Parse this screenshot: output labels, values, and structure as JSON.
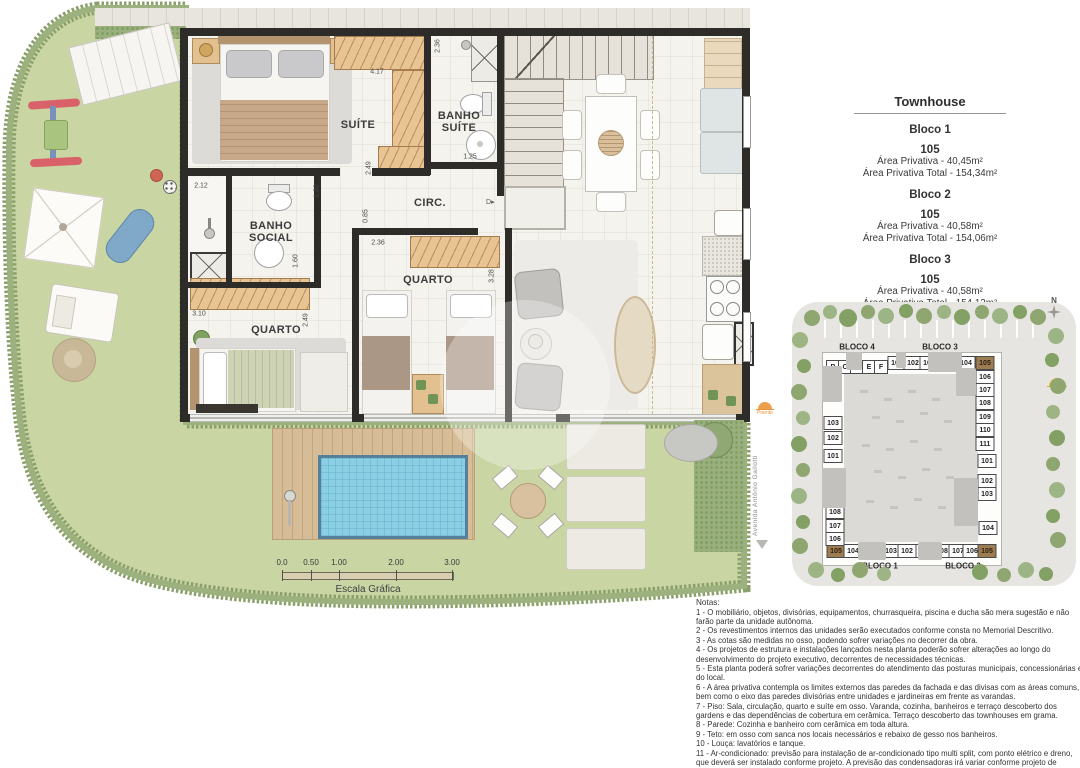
{
  "info_panel": {
    "title": "Townhouse",
    "blocks": [
      {
        "name": "Bloco 1",
        "unit": "105",
        "area1": "Área Privativa - 40,45m²",
        "area2": "Área Privativa Total - 154,34m²"
      },
      {
        "name": "Bloco 2",
        "unit": "105",
        "area1": "Área Privativa - 40,58m²",
        "area2": "Área Privativa Total - 154,06m²"
      },
      {
        "name": "Bloco 3",
        "unit": "105",
        "area1": "Área Privativa - 40,58m²",
        "area2": "Área Privativa Total - 154,12m²"
      }
    ]
  },
  "plan": {
    "room_labels": [
      {
        "t": "SUÍTE",
        "x": 358,
        "y": 125
      },
      {
        "t": "BANHO\nSUÍTE",
        "x": 459,
        "y": 122
      },
      {
        "t": "CIRC.",
        "x": 430,
        "y": 203
      },
      {
        "t": "BANHO\nSOCIAL",
        "x": 271,
        "y": 232
      },
      {
        "t": "QUARTO",
        "x": 276,
        "y": 330
      },
      {
        "t": "QUARTO",
        "x": 428,
        "y": 280
      }
    ],
    "dimensions": [
      {
        "t": "2.36",
        "x": 438,
        "y": 46,
        "r": 1
      },
      {
        "t": "4.17",
        "x": 377,
        "y": 72
      },
      {
        "t": "2.49",
        "x": 369,
        "y": 168,
        "r": 1
      },
      {
        "t": "1.25",
        "x": 470,
        "y": 157
      },
      {
        "t": "2.12",
        "x": 201,
        "y": 186
      },
      {
        "t": "1.32",
        "x": 317,
        "y": 191,
        "r": 1
      },
      {
        "t": "0.85",
        "x": 366,
        "y": 216,
        "r": 1
      },
      {
        "t": "2.36",
        "x": 378,
        "y": 243
      },
      {
        "t": "1.60",
        "x": 296,
        "y": 261,
        "r": 1
      },
      {
        "t": "3.10",
        "x": 199,
        "y": 314
      },
      {
        "t": "2.49",
        "x": 306,
        "y": 320,
        "r": 1
      },
      {
        "t": "3.28",
        "x": 492,
        "y": 276,
        "r": 1
      }
    ],
    "door_symbol": "D",
    "poente_label": "Poente"
  },
  "scalebar": {
    "ticks": [
      {
        "label": "0.0",
        "x": 0
      },
      {
        "label": "0.50",
        "x": 29
      },
      {
        "label": "1.00",
        "x": 57
      },
      {
        "label": "2.00",
        "x": 114
      },
      {
        "label": "3.00",
        "x": 170
      }
    ],
    "caption": "Escala Gráfica"
  },
  "keyplan": {
    "north_label": "N",
    "street": "Avenida Antônio Gallotti",
    "bloco_labels": [
      {
        "t": "BLOCO 4",
        "x": 857,
        "y": 347
      },
      {
        "t": "BLOCO 3",
        "x": 940,
        "y": 347
      },
      {
        "t": "BLOCO 1",
        "x": 880,
        "y": 566
      },
      {
        "t": "BLOCO 2",
        "x": 963,
        "y": 566
      }
    ],
    "cells": [
      {
        "t": "B",
        "x": 833,
        "y": 367
      },
      {
        "t": "C",
        "x": 845,
        "y": 367
      },
      {
        "t": "D",
        "x": 857,
        "y": 367
      },
      {
        "t": "E",
        "x": 869,
        "y": 367
      },
      {
        "t": "F",
        "x": 881,
        "y": 367
      },
      {
        "t": "A",
        "x": 833,
        "y": 384
      },
      {
        "t": "101",
        "x": 897,
        "y": 363
      },
      {
        "t": "102",
        "x": 913,
        "y": 363
      },
      {
        "t": "103",
        "x": 929,
        "y": 363
      },
      {
        "t": "104",
        "x": 966,
        "y": 363
      },
      {
        "t": "105",
        "x": 985,
        "y": 363,
        "h": true
      },
      {
        "t": "106",
        "x": 985,
        "y": 377
      },
      {
        "t": "107",
        "x": 985,
        "y": 390
      },
      {
        "t": "108",
        "x": 985,
        "y": 403
      },
      {
        "t": "109",
        "x": 985,
        "y": 417
      },
      {
        "t": "110",
        "x": 985,
        "y": 430
      },
      {
        "t": "111",
        "x": 985,
        "y": 444
      },
      {
        "t": "101",
        "x": 987,
        "y": 461
      },
      {
        "t": "102",
        "x": 987,
        "y": 481
      },
      {
        "t": "103",
        "x": 987,
        "y": 494
      },
      {
        "t": "104",
        "x": 988,
        "y": 528
      },
      {
        "t": "105",
        "x": 836,
        "y": 551,
        "h": true
      },
      {
        "t": "104",
        "x": 853,
        "y": 551
      },
      {
        "t": "103",
        "x": 891,
        "y": 551
      },
      {
        "t": "102",
        "x": 907,
        "y": 551
      },
      {
        "t": "101",
        "x": 925,
        "y": 551
      },
      {
        "t": "108",
        "x": 942,
        "y": 551
      },
      {
        "t": "107",
        "x": 958,
        "y": 551
      },
      {
        "t": "106",
        "x": 972,
        "y": 551
      },
      {
        "t": "105",
        "x": 987,
        "y": 551,
        "h": true
      },
      {
        "t": "103",
        "x": 833,
        "y": 423
      },
      {
        "t": "102",
        "x": 833,
        "y": 438
      },
      {
        "t": "101",
        "x": 833,
        "y": 456
      },
      {
        "t": "108",
        "x": 835,
        "y": 512
      },
      {
        "t": "107",
        "x": 835,
        "y": 526
      },
      {
        "t": "106",
        "x": 835,
        "y": 539
      }
    ]
  },
  "notes": {
    "heading": "Notas:",
    "items": [
      "1 - O mobiliário, objetos, divisórias, equipamentos, churrasqueira, piscina e ducha são mera sugestão e não farão parte da unidade autônoma.",
      "2 - Os revestimentos internos das unidades serão executados conforme consta no Memorial Descritivo.",
      "3 - As cotas são medidas no osso, podendo sofrer variações no decorrer da obra.",
      "4 - Os projetos de estrutura e instalações lançados nesta planta poderão sofrer alterações ao longo do desenvolvimento do projeto executivo, decorrentes de necessidades técnicas.",
      "5 - Esta planta poderá sofrer variações decorrentes do atendimento das posturas municipais, concessionárias e do local.",
      "6 - A área privativa contempla os limites externos das paredes da fachada e das divisas com as áreas comuns, bem como o eixo das paredes divisórias entre unidades e jardineiras em frente as varandas.",
      "7 - Piso: Sala, circulação, quarto e suíte em osso. Varanda, cozinha, banheiros e terraço descoberto dos gardens e das dependências de cobertura em cerâmica. Terraço descoberto das townhouses em grama.",
      "8 - Parede: Cozinha e banheiro com cerâmica em toda altura.",
      "9 - Teto: em osso com sanca nos locais necessários e rebaixo de gesso nos banheiros.",
      "10 - Louça: lavatórios e tanque.",
      "11 - Ar-condicionado: previsão para instalação de ar-condicionado tipo multi split, com ponto elétrico e dreno, que deverá ser instalado conforme projeto. A previsão das condensadoras irá variar conforme projeto de fachada."
    ]
  },
  "colors": {
    "grass": "#c9d6a4",
    "hedge": "#8ba06c",
    "wall": "#2e2c29",
    "pool": "#8bcfe5",
    "deck": "#d7bd97",
    "closet_tan": "#e7c491",
    "keyplan_highlight": "#9c7c50",
    "sun_orange": "#e8923a"
  }
}
